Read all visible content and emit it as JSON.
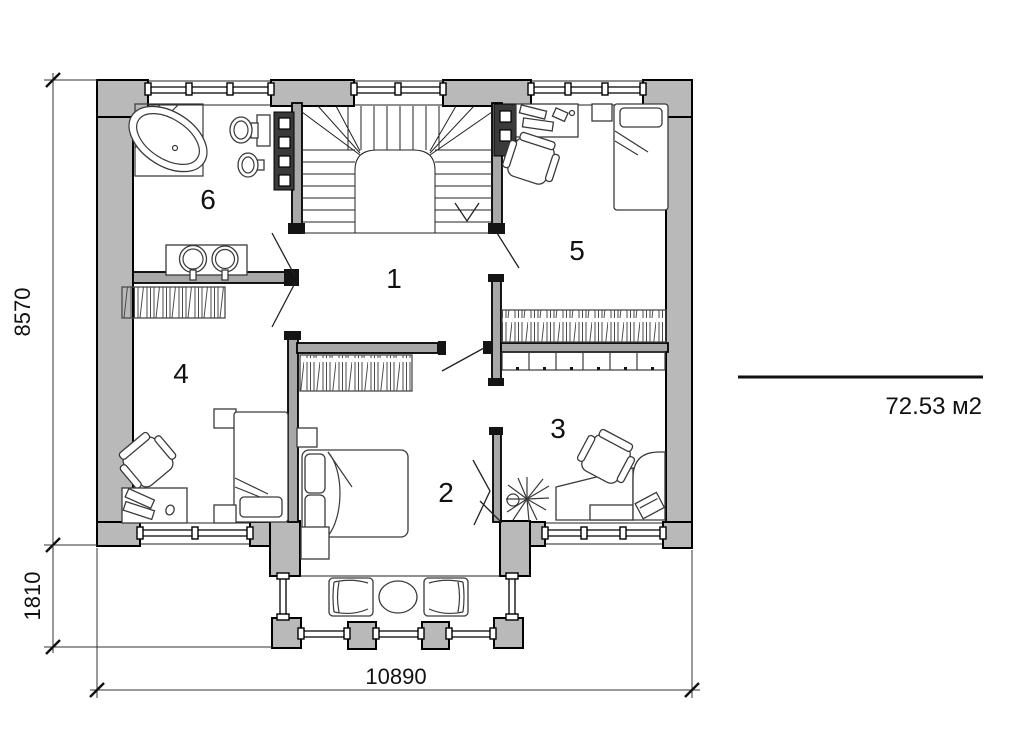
{
  "document": {
    "type": "architectural-floor-plan"
  },
  "room_labels": {
    "r1": "1",
    "r2": "2",
    "r3": "3",
    "r4": "4",
    "r5": "5",
    "r6": "6"
  },
  "dimensions": {
    "left_height": "8570",
    "balcony_depth": "1810",
    "bottom_width": "10890"
  },
  "area": {
    "label": "72.53 м2"
  },
  "colors": {
    "wall_fill": "#b9b9b9",
    "interior_wall_fill": "#a8a8a8",
    "line": "#000000",
    "furniture_line": "#3a3a3a",
    "background": "#ffffff"
  }
}
